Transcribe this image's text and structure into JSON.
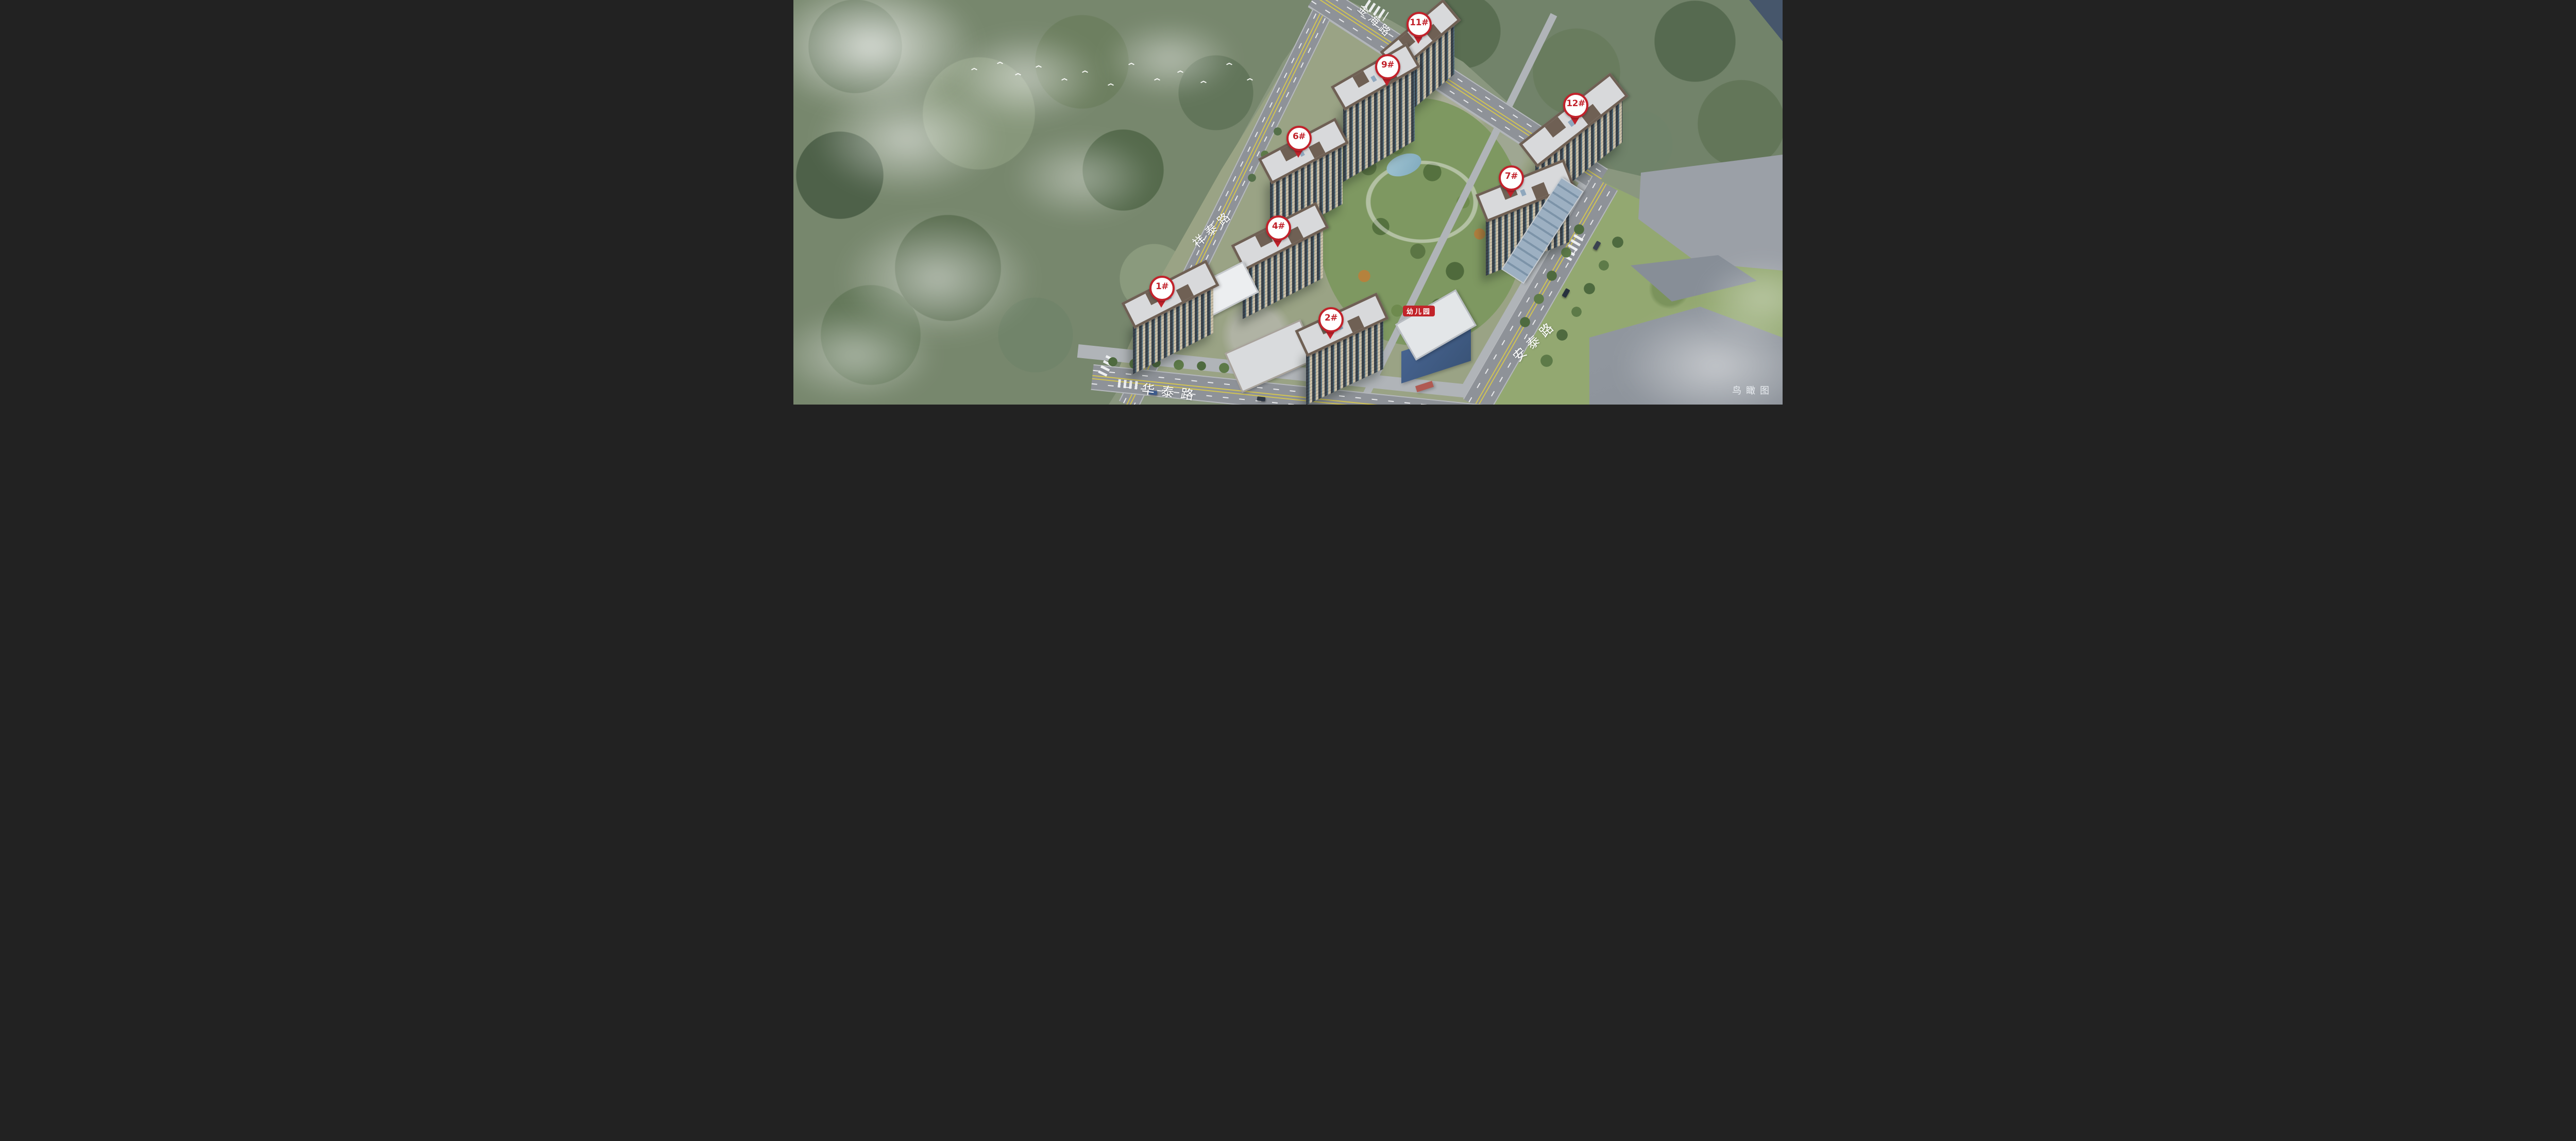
{
  "scene": {
    "type": "aerial-masterplan-rendering",
    "caption": "鸟瞰图"
  },
  "roads": [
    {
      "name": "金海路"
    },
    {
      "name": "祥泰路"
    },
    {
      "name": "安泰路"
    },
    {
      "name": "华泰路"
    }
  ],
  "buildings": [
    {
      "label": "1#"
    },
    {
      "label": "2#"
    },
    {
      "label": "4#"
    },
    {
      "label": "6#"
    },
    {
      "label": "7#"
    },
    {
      "label": "9#"
    },
    {
      "label": "11#"
    },
    {
      "label": "12#"
    }
  ],
  "facilities": [
    {
      "label": "幼儿园"
    }
  ],
  "colors": {
    "pin_red": "#c2222b",
    "facility_red": "#c2242a",
    "road_label": "#ffffff"
  }
}
